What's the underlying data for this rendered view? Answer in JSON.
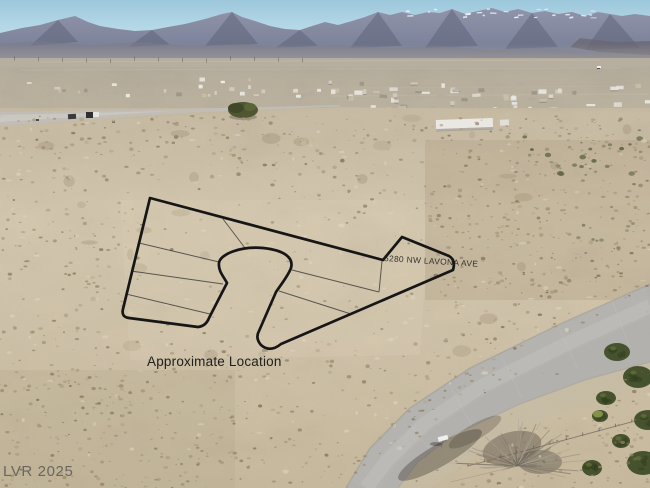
{
  "overlay": {
    "address_label": "5280 NW LAVONA AVE",
    "location_label": "Approximate Location"
  },
  "watermark": {
    "text": "LVR 2025"
  },
  "colors": {
    "sky_top": "#9cc7db",
    "sky_horizon": "#d3ecf3",
    "mountain_top": "#8f94aa",
    "mountain_bottom": "#757b93",
    "mountain_shadow": "#5d6278",
    "snow": "#eff2f5",
    "valley_haze": "#b6b0a2",
    "town_ground": "#bcb3a1",
    "house_white": "#f0eee8",
    "desert_top": "#c9bca4",
    "desert_mid": "#d6cab1",
    "desert_bottom": "#cabc9f",
    "speckle_dark": "#8a7a60",
    "road_asphalt": "#b4b3af",
    "road_worn": "#c6c5c1",
    "boundary_line": "#161616",
    "lot_line": "#2b2b2b",
    "tree_green": "#47532e",
    "bare_tree": "#a79c8d",
    "label_text": "#22201d",
    "watermark_text": "#4a4a48"
  }
}
